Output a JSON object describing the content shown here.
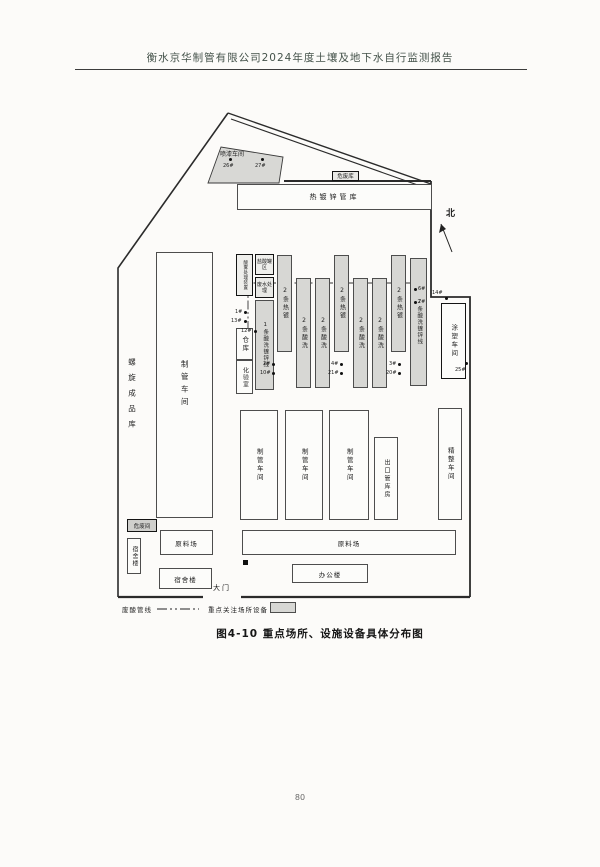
{
  "header": {
    "title": "衡水京华制管有限公司2024年度土壤及地下水自行监测报告"
  },
  "caption": "图4-10  重点场所、设施设备具体分布图",
  "page_number": "80",
  "compass_label": "北",
  "gate_label": "大门",
  "legend": {
    "pipeline_label": "废酸管线",
    "key_sites_label": "重点关注场所设备"
  },
  "buildings": {
    "paint_shop": "喷漆车间",
    "galv_pipe_warehouse": "热镀锌管库",
    "hazardous_waste_store": "危废库",
    "spiral_product_warehouse": "螺旋成品库",
    "pipe_workshop": "制管车间",
    "acid_mist_unit": "酸雾处理装置",
    "warehouse": "仓库",
    "lab": "化验室",
    "acid_tank_area": "盐酸罐区",
    "wastewater_treatment": "废水处理",
    "coating_workshop": "涂塑车间",
    "export_pipe_warehouse": "出口管库房",
    "finishing_workshop": "精整车间",
    "hazardous_waste_room": "危废间",
    "dormitory": "宿舍楼",
    "raw_material_yard": "原料场",
    "office_building": "办公楼"
  },
  "strips": [
    {
      "label": "1条酸洗镀锌线"
    },
    {
      "label": "2条热镀"
    },
    {
      "label": "2条酸洗"
    },
    {
      "label": "2条酸洗"
    },
    {
      "label": "2条热镀"
    },
    {
      "label": "2条酸洗"
    },
    {
      "label": "2条酸洗"
    },
    {
      "label": "2条热镀"
    },
    {
      "label": "2条酸洗镀锌线"
    }
  ],
  "markers": [
    {
      "label": "26#"
    },
    {
      "label": "27#"
    },
    {
      "label": "1#"
    },
    {
      "label": "13#"
    },
    {
      "label": "12#"
    },
    {
      "label": "2#"
    },
    {
      "label": "10#"
    },
    {
      "label": "4#"
    },
    {
      "label": "21#"
    },
    {
      "label": "3#"
    },
    {
      "label": "20#"
    },
    {
      "label": "6#"
    },
    {
      "label": "7#"
    },
    {
      "label": "14#"
    },
    {
      "label": "25#"
    }
  ],
  "colors": {
    "key_fill": "#d7d7d4",
    "line": "#2b2b2b"
  }
}
